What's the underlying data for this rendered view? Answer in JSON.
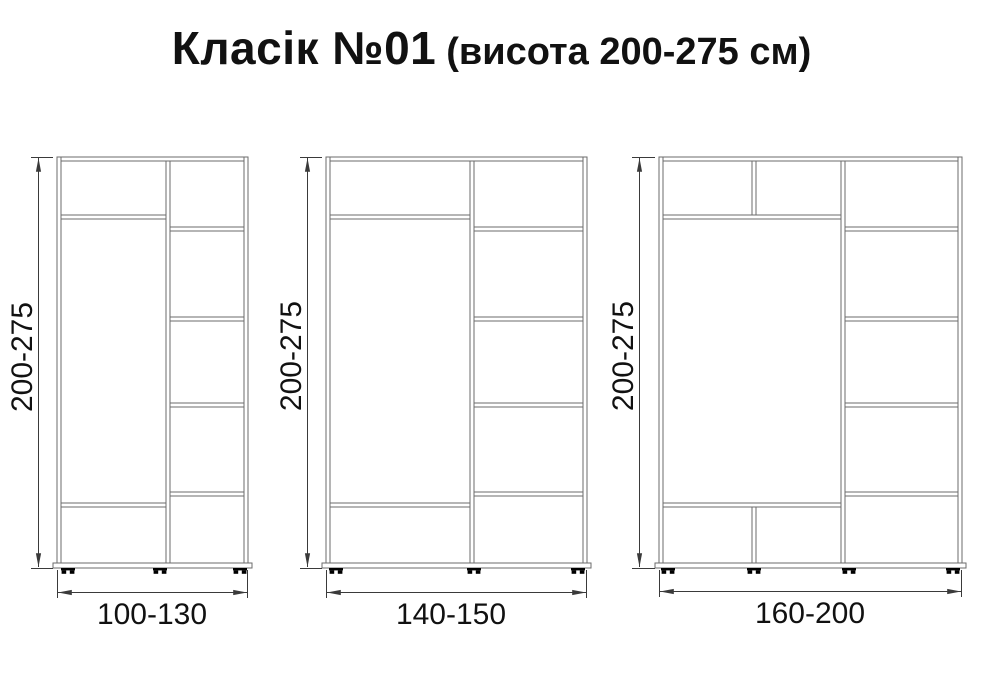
{
  "title": {
    "main": "Класік №01",
    "suffix": "(висота 200-275 см)"
  },
  "wardrobes": [
    {
      "name": "small",
      "height_label": "200-275",
      "width_label": "100-130"
    },
    {
      "name": "medium",
      "height_label": "200-275",
      "width_label": "140-150"
    },
    {
      "name": "large",
      "height_label": "200-275",
      "width_label": "160-200"
    }
  ],
  "units": "см",
  "colors": {
    "background": "#ffffff",
    "panel_line": "#6b6b6b",
    "dimension_line": "#3a3a3a",
    "text": "#111111"
  }
}
